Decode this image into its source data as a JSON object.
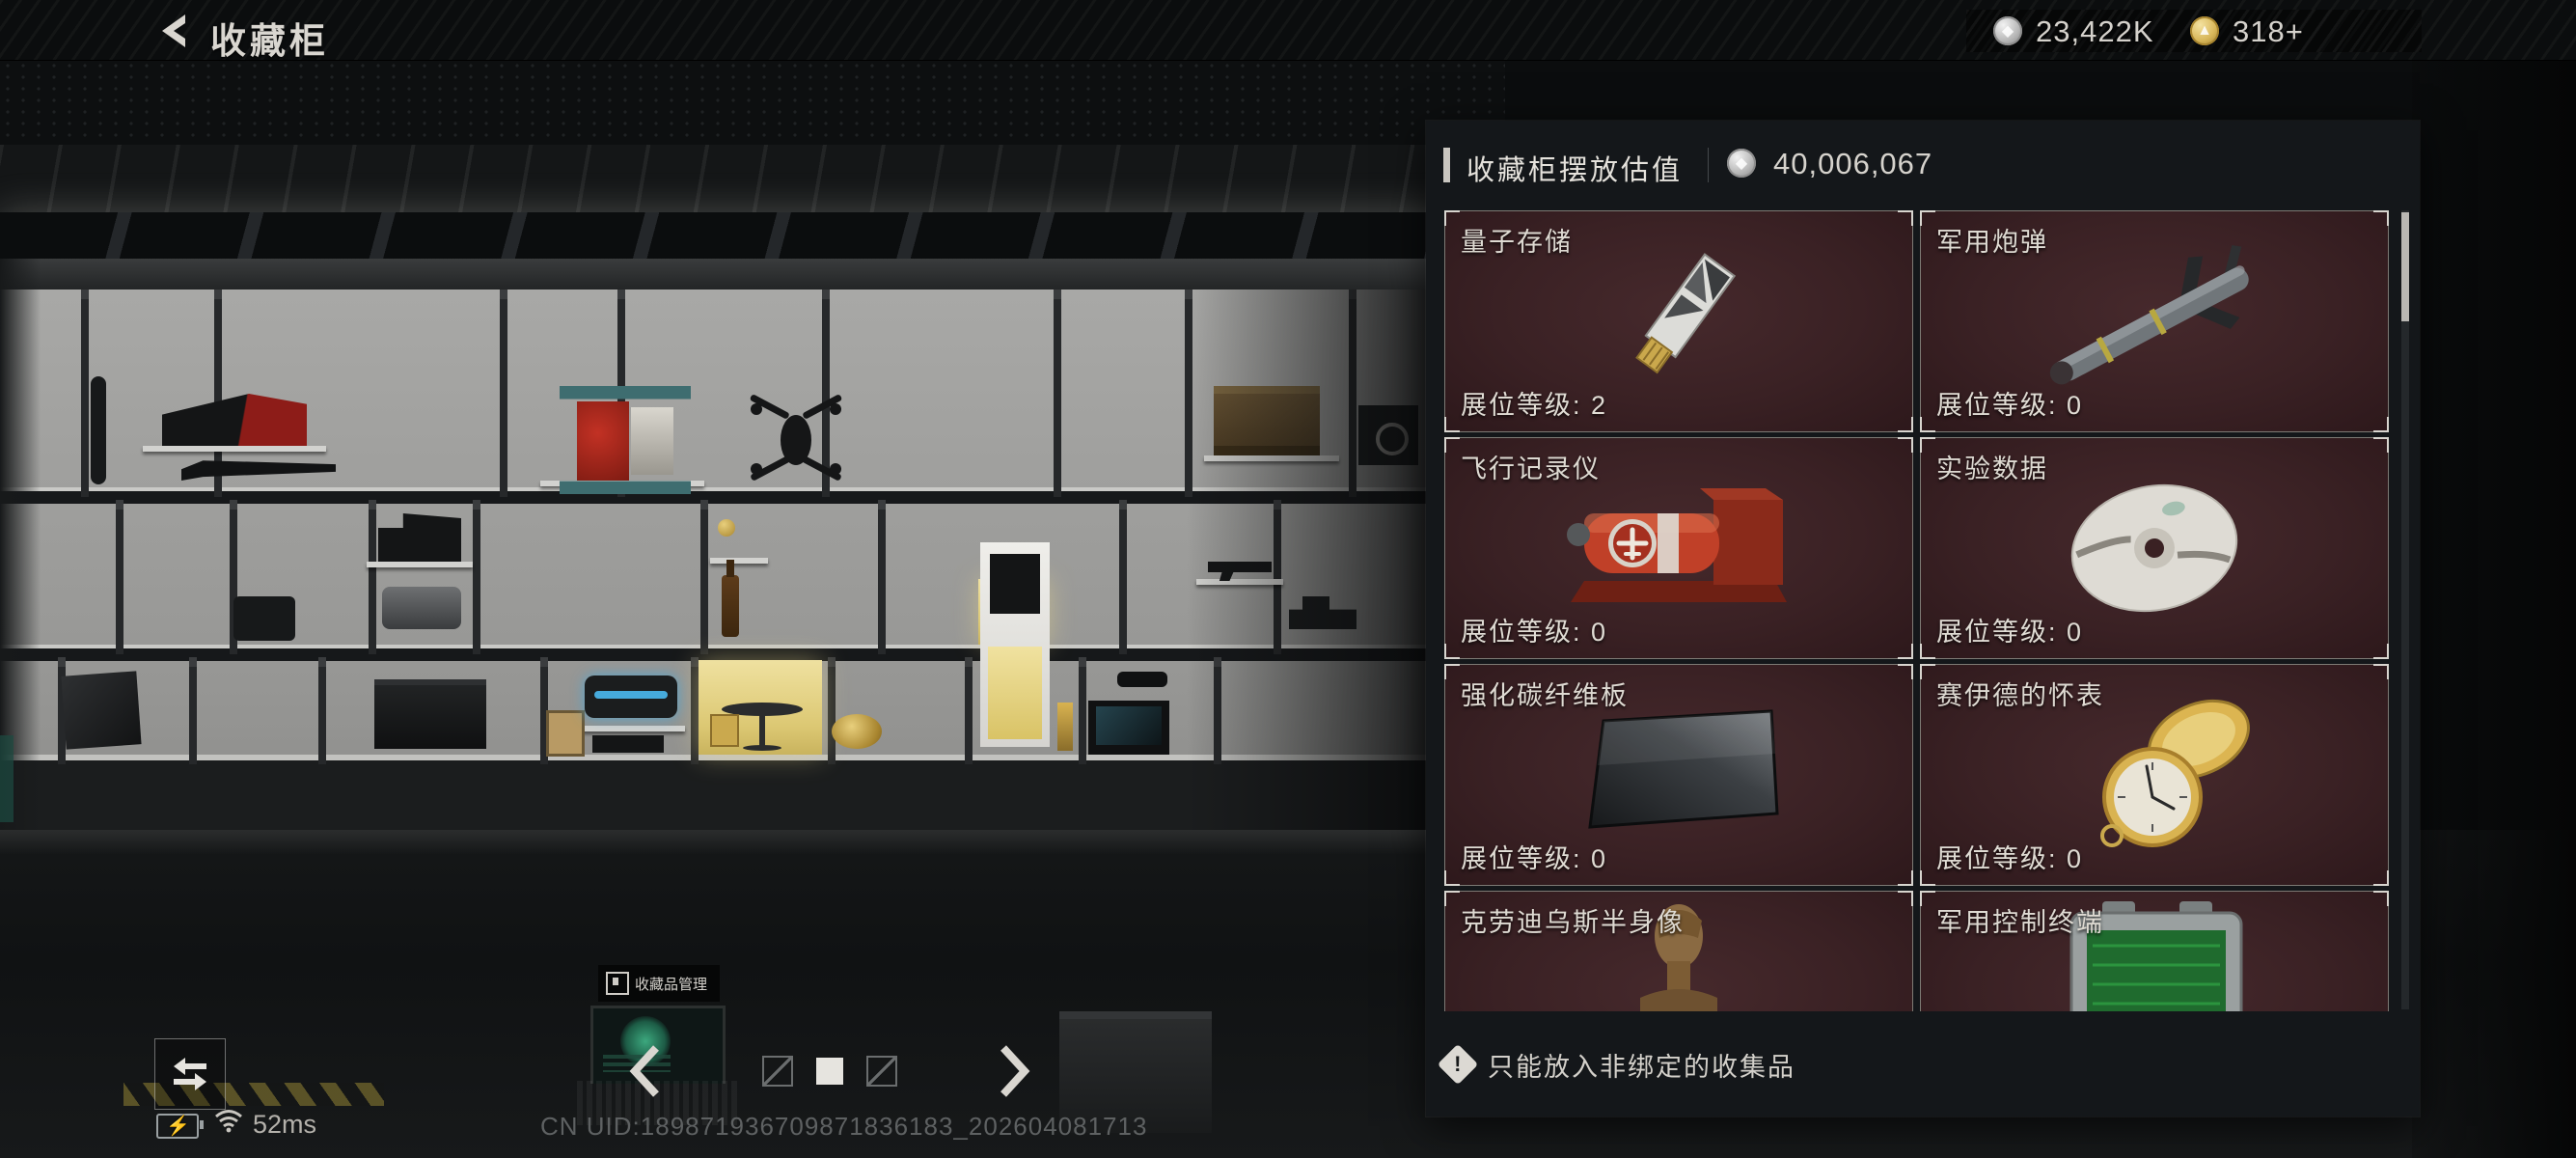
{
  "topbar": {
    "title": "收藏柜",
    "currency_silver": "23,422K",
    "currency_gold": "318+"
  },
  "panel": {
    "header_title": "收藏柜摆放估值",
    "header_value": "40,006,067",
    "tip_icon": "exclamation-diamond",
    "tip": "只能放入非绑定的收集品",
    "items": [
      {
        "name": "量子存储",
        "level": "展位等级: 2",
        "art": "usb-drive"
      },
      {
        "name": "军用炮弹",
        "level": "展位等级: 0",
        "art": "missile"
      },
      {
        "name": "飞行记录仪",
        "level": "展位等级: 0",
        "art": "flight-recorder"
      },
      {
        "name": "实验数据",
        "level": "展位等级: 0",
        "art": "data-disc"
      },
      {
        "name": "强化碳纤维板",
        "level": "展位等级: 0",
        "art": "carbon-plate"
      },
      {
        "name": "赛伊德的怀表",
        "level": "展位等级: 0",
        "art": "pocket-watch"
      },
      {
        "name": "克劳迪乌斯半身像",
        "level": "",
        "art": "bronze-bust"
      },
      {
        "name": "军用控制终端",
        "level": "",
        "art": "control-terminal"
      }
    ]
  },
  "scene": {
    "laptop_label": "收藏品管理"
  },
  "footer": {
    "ping": "52ms",
    "uid": "CN UID:189871936709871836183_202604081713"
  },
  "colors": {
    "card_bg": "#3a2124",
    "panel_bg": "#14171a",
    "highlight_cell": "#e9d98e",
    "gold_coin": "#d8b75a",
    "silver_coin": "#b9b9b9"
  }
}
